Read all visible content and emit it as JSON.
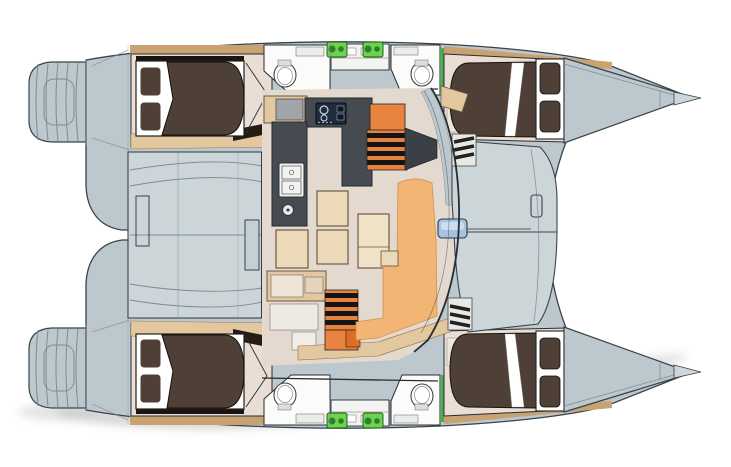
{
  "diagram": {
    "type": "catamaran-deck-plan",
    "view": "top-down floor plan, bows pointing right",
    "hull_count": 2,
    "cabin_count": 4,
    "double_bed_count": 4,
    "bathroom_count": 4,
    "regions": [
      {
        "name": "swim-platform-port",
        "desc": "stepped transom platform, aft end of top hull"
      },
      {
        "name": "swim-platform-starboard",
        "desc": "stepped transom platform, aft end of bottom hull"
      },
      {
        "name": "aft-cabin-top",
        "desc": "aft double cabin in top hull with dark brown duvet and two pillows"
      },
      {
        "name": "forward-cabin-top",
        "desc": "forward double cabin in top hull, pillows toward bow"
      },
      {
        "name": "aft-cabin-bottom",
        "desc": "aft double cabin in bottom hull"
      },
      {
        "name": "forward-cabin-bottom",
        "desc": "forward double cabin in bottom hull"
      },
      {
        "name": "bathroom-aft-top",
        "desc": "en-suite head with toilet/basin oval"
      },
      {
        "name": "bathroom-forward-top",
        "desc": "en-suite head with toilet/basin oval"
      },
      {
        "name": "bathroom-aft-bottom",
        "desc": "en-suite head"
      },
      {
        "name": "bathroom-forward-bottom",
        "desc": "en-suite head"
      },
      {
        "name": "cockpit",
        "desc": "aft cockpit between hulls with two bench seats"
      },
      {
        "name": "salon",
        "desc": "central salon with U-shaped charcoal galley, stove, double sink, dinette table and seats"
      },
      {
        "name": "companionway-steps-top",
        "desc": "orange steps with black treads down to top hull"
      },
      {
        "name": "companionway-steps-bottom",
        "desc": "orange steps with black treads down to bottom hull"
      },
      {
        "name": "lounge-sofa",
        "desc": "orange L-shaped lounge seating on forward side of salon"
      },
      {
        "name": "foredeck",
        "desc": "forward deck between hulls with mast base"
      },
      {
        "name": "bow-port",
        "desc": "pointed bow of top hull"
      },
      {
        "name": "bow-starboard",
        "desc": "pointed bow of bottom hull"
      },
      {
        "name": "engine-hatches",
        "desc": "green equipment hatches on inboard side of each hull"
      }
    ]
  },
  "palette": {
    "hull": "#bcc8cd",
    "hull-light": "#ccd6d9",
    "hull-stroke": "#39434a",
    "hull-line": "#7d8c93",
    "cabin-floor": "#e9ddd4",
    "wood": "#e2c79f",
    "wood-dark": "#c9a272",
    "bed-duvet": "#4e4037",
    "bed-stroke": "#15100c",
    "bath-white": "#fbfbf9",
    "galley": "#454b51",
    "stove": "#1d2b3d",
    "steps-orange": "#e8823f",
    "sofa-orange": "#f3b574",
    "seat-tan": "#ecd9ba",
    "salon-floor": "#e3d9cf",
    "table-stroke": "#63503a",
    "green-equip": "#6fd24c",
    "green-dark": "#2e7d32",
    "green-wall": "#53a653",
    "mast-blue": "#a9c2de",
    "outline": "#262d33",
    "dark-wedge": "#3a4045",
    "near-black": "#151515",
    "shadow": "#c6c6c6"
  }
}
